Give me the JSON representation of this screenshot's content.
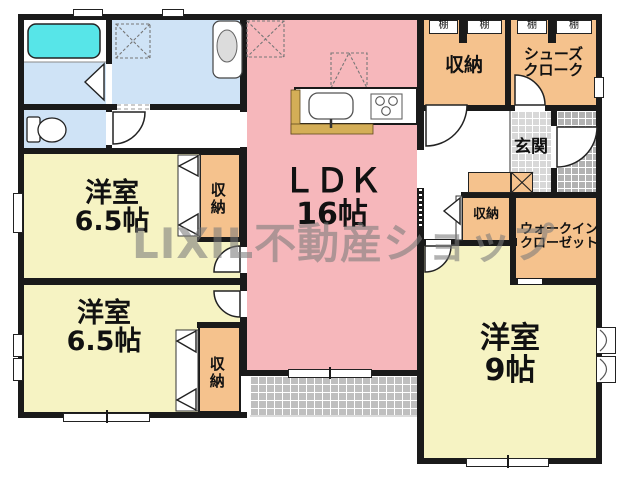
{
  "plan": {
    "watermark": "LIXIL不動産ショップ",
    "rooms": {
      "ldk": {
        "name": "ＬＤＫ",
        "size": "16帖"
      },
      "bedroom_upper_left": {
        "name": "洋室",
        "size": "6.5帖"
      },
      "bedroom_lower_left": {
        "name": "洋室",
        "size": "6.5帖"
      },
      "bedroom_right": {
        "name": "洋室",
        "size": "9帖"
      },
      "entrance": {
        "name": "玄関"
      },
      "storage": {
        "name": "収納"
      },
      "shoe_closet": {
        "line1": "シューズ",
        "line2": "クローク"
      },
      "walk_in_closet": {
        "line1": "ウォークイン",
        "line2": "クローゼット"
      },
      "shelf": "棚"
    },
    "colors": {
      "ldk_pink": "#f6b7bb",
      "bedroom_yellow": "#f6f3c3",
      "closet_orange": "#f5c28d",
      "washroom_blue": "#cfe3f6",
      "bathtub_cyan": "#57e5e8",
      "counter_tan": "#d4ae57",
      "wall_black": "#1a1a1a",
      "genkan_tile": "#d8d8d8",
      "porch_tile": "#b2b2b2",
      "terrace_tile": "#bfbfbf",
      "watermark_gray": "#7a7a7a"
    }
  }
}
